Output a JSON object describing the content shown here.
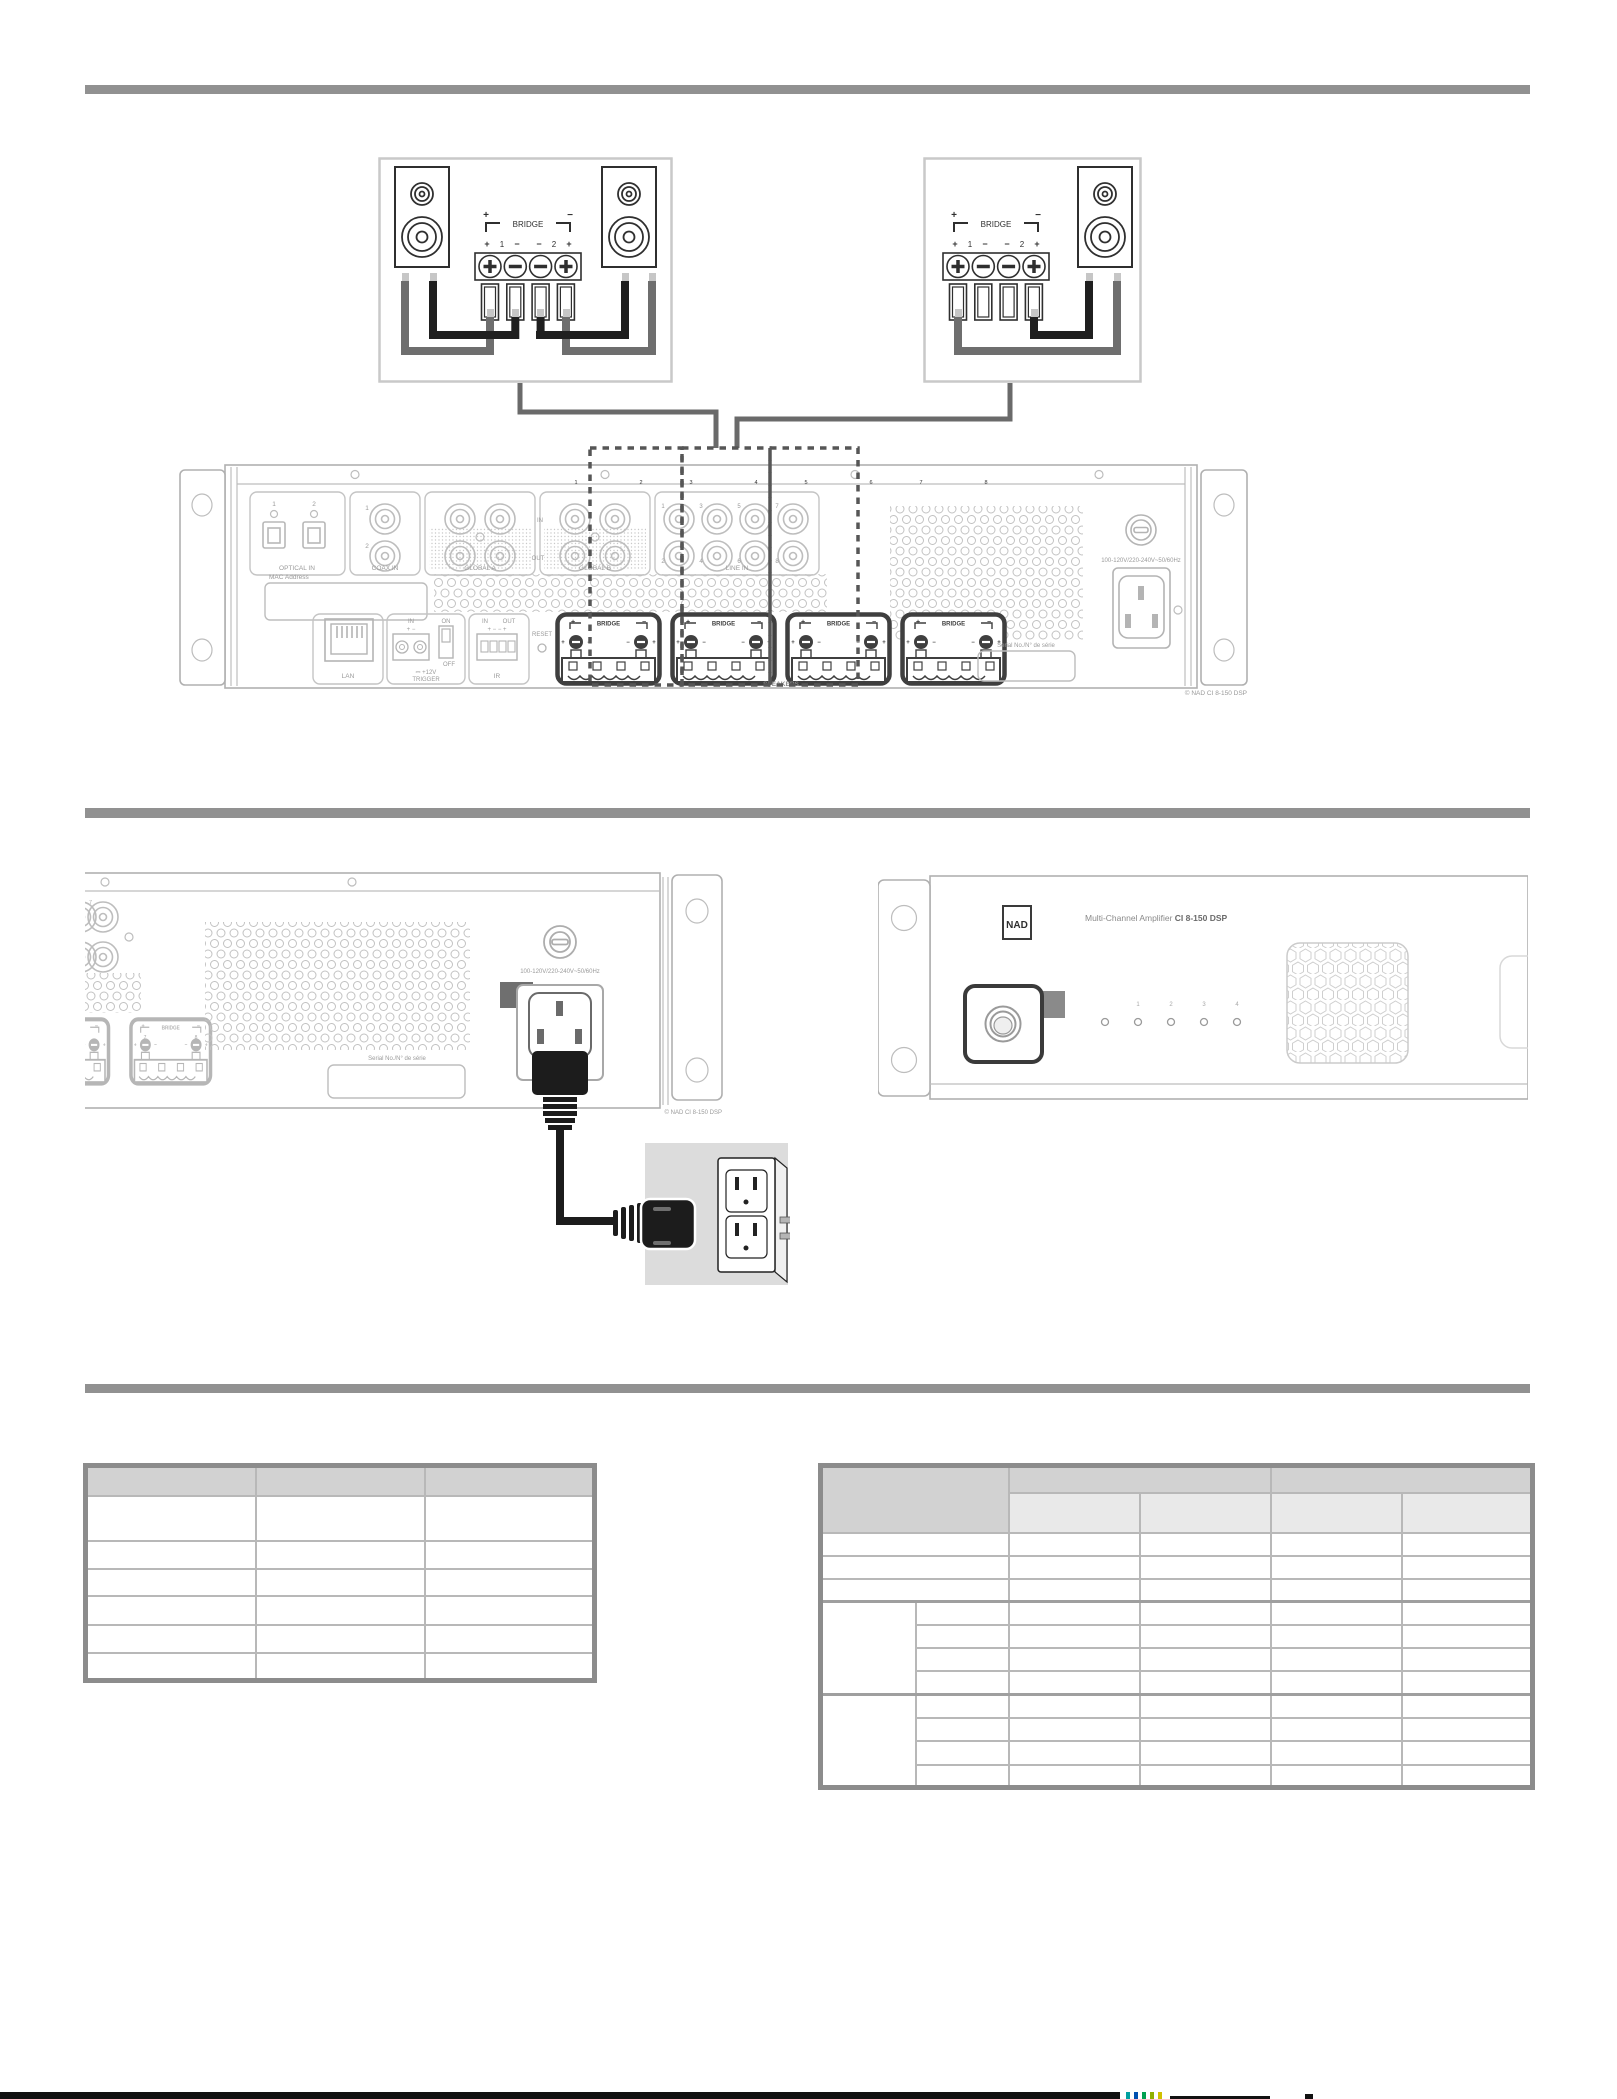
{
  "section_bridge": {
    "bridge_block": {
      "plus": "+",
      "minus": "−",
      "label": "BRIDGE",
      "t_plus_l": "+",
      "t_num_l": "1",
      "t_minus_l": "−",
      "t_minus_r": "−",
      "t_num_r": "2",
      "t_plus_r": "+"
    }
  },
  "rear_panel": {
    "optical_n1": "1",
    "optical_n2": "2",
    "optical_label": "OPTICAL IN",
    "coax_n1": "1",
    "coax_n2": "2",
    "coax_label": "COAX IN",
    "global_a_label": "GLOBAL A",
    "global_b_label": "GLOBAL B",
    "in_label": "IN",
    "out_label": "OUT",
    "line_label": "LINE IN",
    "line_top": [
      "1",
      "3",
      "5",
      "7"
    ],
    "line_bottom": [
      "2",
      "4",
      "6",
      "8"
    ],
    "mac_label": "MAC Address",
    "lan_label": "LAN",
    "trig_in": "IN",
    "trig_pm": "+ −",
    "on": "ON",
    "off": "OFF",
    "trigger_line1": "⎓ +12V",
    "trigger_line2": "TRIGGER",
    "ir_in": "IN",
    "ir_out": "OUT",
    "ir_pm": "+ − − +",
    "ir_label": "IR",
    "reset_label": "RESET",
    "speakers_label": "SPEAKERS",
    "channels": [
      [
        "1",
        "2"
      ],
      [
        "3",
        "4"
      ],
      [
        "5",
        "6"
      ],
      [
        "7",
        "8"
      ]
    ],
    "voltage_label": "100-120V/220-240V~50/60Hz",
    "serial_label": "Serial No./N° de série",
    "copyright": "© NAD  CI 8-150 DSP"
  },
  "power_section": {
    "line_jack_num": "7",
    "ch7": "7",
    "ch8": "8",
    "voltage_label": "100-120V/220-240V~50/60Hz",
    "serial_label": "Serial No./N° de série",
    "copyright": "© NAD  CI 8-150 DSP"
  },
  "front_panel": {
    "logo": "NAD",
    "title": "Multi-Channel Amplifier ",
    "model": "CI 8-150 DSP",
    "led_labels": [
      "1",
      "2",
      "3",
      "4"
    ]
  }
}
